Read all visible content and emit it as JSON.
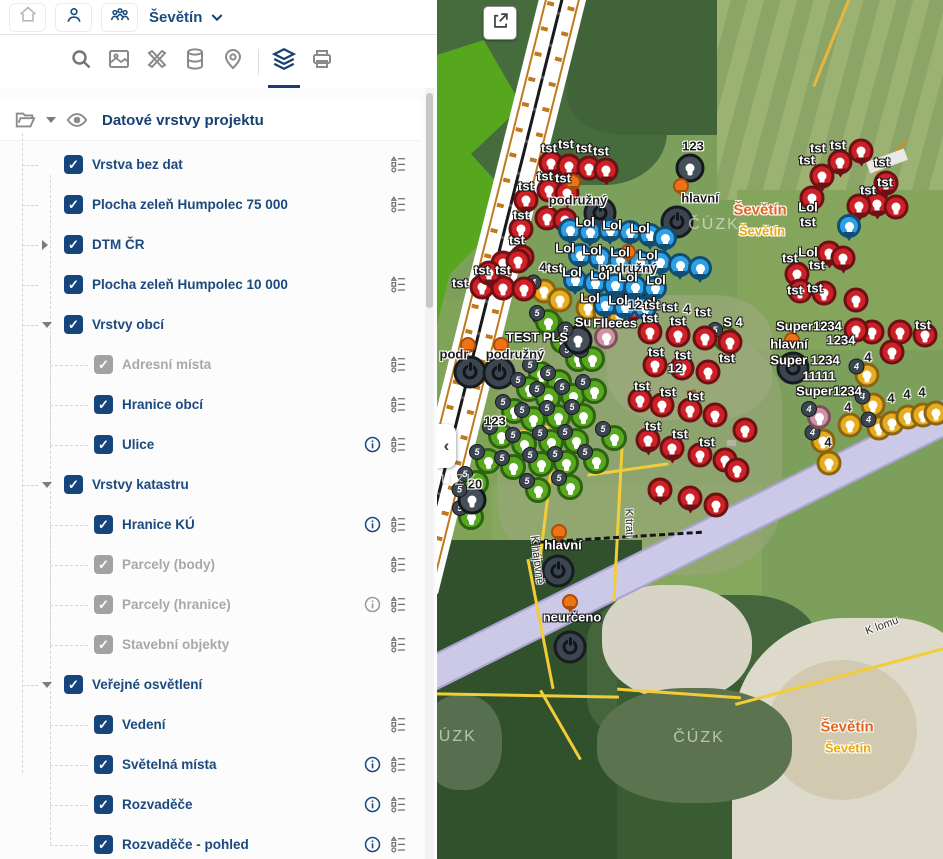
{
  "header": {
    "title": "Ševětín",
    "icons": [
      "home-icon",
      "user-icon",
      "team-icon",
      "chevron-down-icon"
    ]
  },
  "toolbar": {
    "icons": [
      "search-icon",
      "basemap-icon",
      "draw-tools-icon",
      "database-icon",
      "location-pin-icon",
      "layers-icon",
      "print-icon"
    ],
    "active_icon": "layers-icon"
  },
  "sidebar": {
    "panel_title": "Datové vrstvy projektu",
    "panel_icons": [
      "folder-open-icon",
      "chevron-down-icon",
      "eye-icon"
    ],
    "tree": [
      {
        "label": "Vrstva bez dat",
        "level": 1,
        "checked": true,
        "legend": true
      },
      {
        "label": "Plocha zeleň Humpolec 75 000",
        "level": 1,
        "checked": true,
        "legend": true
      },
      {
        "label": "DTM ČR",
        "level": 1,
        "checked": true,
        "arrow": "right"
      },
      {
        "label": "Plocha zeleň Humpolec 10 000",
        "level": 1,
        "checked": true,
        "legend": true
      },
      {
        "label": "Vrstvy obcí",
        "level": 1,
        "checked": true,
        "arrow": "down"
      },
      {
        "label": "Adresní místa",
        "level": 2,
        "checked": true,
        "disabled": true,
        "legend": true
      },
      {
        "label": "Hranice obcí",
        "level": 2,
        "checked": true,
        "legend": true
      },
      {
        "label": "Ulice",
        "level": 2,
        "checked": true,
        "info": true,
        "legend": true
      },
      {
        "label": "Vrstvy katastru",
        "level": 1,
        "checked": true,
        "arrow": "down"
      },
      {
        "label": "Hranice KÚ",
        "level": 2,
        "checked": true,
        "info": true,
        "legend": true
      },
      {
        "label": "Parcely (body)",
        "level": 2,
        "checked": true,
        "disabled": true,
        "legend": true
      },
      {
        "label": "Parcely (hranice)",
        "level": 2,
        "checked": true,
        "disabled": true,
        "info": true,
        "legend": true
      },
      {
        "label": "Stavební objekty",
        "level": 2,
        "checked": true,
        "disabled": true,
        "legend": true
      },
      {
        "label": "Veřejné osvětlení",
        "level": 1,
        "checked": true,
        "arrow": "down"
      },
      {
        "label": "Vedení",
        "level": 2,
        "checked": true,
        "legend": true
      },
      {
        "label": "Světelná místa",
        "level": 2,
        "checked": true,
        "info": true,
        "legend": true
      },
      {
        "label": "Rozvaděče",
        "level": 2,
        "checked": true,
        "info": true,
        "legend": true
      },
      {
        "label": "Rozvaděče - pohled",
        "level": 2,
        "checked": true,
        "info": true,
        "legend": true
      }
    ]
  },
  "map": {
    "collapse_glyph": "‹",
    "colors": {
      "red": "#cf2028",
      "green": "#58a81f",
      "blue": "#2da0e8",
      "yellow": "#e6ac1e",
      "pink": "#cf93a4",
      "dark": "#454f58",
      "orange": "#ee7317",
      "lavender": "#ccc8e8",
      "city_label": "#e0641e",
      "accent": "#15457c"
    },
    "markers": [
      [
        "dl",
        163,
        213
      ],
      [
        "dl",
        240,
        222
      ],
      [
        "dl",
        192,
        296
      ],
      [
        "dl",
        33,
        372
      ],
      [
        "dl",
        62,
        373
      ],
      [
        "dl",
        356,
        368
      ],
      [
        "dl",
        121,
        571
      ],
      [
        "dl",
        133,
        647
      ],
      [
        "gc",
        114,
        326,
        "5"
      ],
      [
        "gc",
        126,
        341,
        "5"
      ],
      [
        "gc",
        141,
        359,
        "5"
      ],
      [
        "gc",
        104,
        374,
        "5"
      ],
      [
        "gc",
        122,
        382,
        "5"
      ],
      [
        "gc",
        155,
        359,
        "5"
      ],
      [
        "gc",
        92,
        389,
        "5"
      ],
      [
        "gc",
        111,
        398,
        "5"
      ],
      [
        "gc",
        136,
        396,
        "5"
      ],
      [
        "gc",
        157,
        391,
        "5"
      ],
      [
        "gc",
        77,
        411,
        "5"
      ],
      [
        "gc",
        96,
        419,
        "5"
      ],
      [
        "gc",
        121,
        417,
        "5"
      ],
      [
        "gc",
        146,
        416,
        "5"
      ],
      [
        "gc",
        64,
        436,
        "5"
      ],
      [
        "gc",
        87,
        444,
        "5"
      ],
      [
        "gc",
        114,
        442,
        "5"
      ],
      [
        "gc",
        139,
        441,
        "5"
      ],
      [
        "gc",
        51,
        461,
        "5"
      ],
      [
        "gc",
        76,
        467,
        "5"
      ],
      [
        "gc",
        104,
        464,
        "5"
      ],
      [
        "gc",
        129,
        463,
        "5"
      ],
      [
        "gc",
        39,
        483,
        "5"
      ],
      [
        "gc",
        159,
        461,
        "5"
      ],
      [
        "gc",
        101,
        490,
        "5"
      ],
      [
        "gc",
        133,
        487,
        "5"
      ],
      [
        "gc",
        34,
        517,
        "5"
      ],
      [
        "gc",
        177,
        438,
        "5"
      ],
      [
        "gc",
        289,
        339,
        "5"
      ],
      [
        "gc",
        111,
        322,
        "5"
      ],
      [
        "yc",
        107,
        291,
        "4"
      ],
      [
        "yc",
        123,
        300
      ],
      [
        "yc",
        151,
        308
      ],
      [
        "yc",
        168,
        312
      ],
      [
        "yc",
        183,
        316
      ],
      [
        "yc",
        430,
        375,
        "4"
      ],
      [
        "yc",
        436,
        405,
        "4"
      ],
      [
        "yc",
        413,
        425
      ],
      [
        "yc",
        442,
        428,
        "4"
      ],
      [
        "yc",
        455,
        423
      ],
      [
        "yc",
        471,
        417
      ],
      [
        "yc",
        486,
        415
      ],
      [
        "yc",
        499,
        413
      ],
      [
        "yc",
        386,
        441,
        "4"
      ],
      [
        "yc",
        392,
        463
      ],
      [
        "pc",
        169,
        337
      ],
      [
        "pc",
        382,
        417,
        "4"
      ],
      [
        "rp",
        114,
        163
      ],
      [
        "rp",
        132,
        166
      ],
      [
        "rc",
        152,
        168
      ],
      [
        "rp",
        169,
        170
      ],
      [
        "rc",
        112,
        190
      ],
      [
        "rp",
        130,
        193
      ],
      [
        "rc",
        110,
        218
      ],
      [
        "rp",
        128,
        220
      ],
      [
        "rp",
        89,
        200
      ],
      [
        "rc",
        84,
        229
      ],
      [
        "rp",
        85,
        257
      ],
      [
        "rc",
        66,
        263
      ],
      [
        "rc",
        81,
        261
      ],
      [
        "rc",
        45,
        287
      ],
      [
        "rc",
        66,
        288
      ],
      [
        "rc",
        87,
        289
      ],
      [
        "rp",
        52,
        273
      ],
      [
        "rc",
        178,
        302
      ],
      [
        "rc",
        196,
        308
      ],
      [
        "rc",
        213,
        332
      ],
      [
        "rc",
        241,
        335
      ],
      [
        "rc",
        268,
        338
      ],
      [
        "rc",
        293,
        342
      ],
      [
        "rc",
        218,
        365
      ],
      [
        "rc",
        245,
        368
      ],
      [
        "rc",
        271,
        372
      ],
      [
        "rc",
        203,
        400
      ],
      [
        "rc",
        225,
        405
      ],
      [
        "rc",
        253,
        410
      ],
      [
        "rc",
        278,
        415
      ],
      [
        "rp",
        211,
        440
      ],
      [
        "rp",
        235,
        448
      ],
      [
        "rc",
        263,
        455
      ],
      [
        "rc",
        288,
        460
      ],
      [
        "rp",
        223,
        490
      ],
      [
        "rp",
        253,
        498
      ],
      [
        "rc",
        279,
        505
      ],
      [
        "rc",
        300,
        470
      ],
      [
        "rc",
        308,
        430
      ],
      [
        "rp",
        403,
        162
      ],
      [
        "rp",
        385,
        176
      ],
      [
        "rp",
        375,
        198
      ],
      [
        "rp",
        424,
        151
      ],
      [
        "rp",
        449,
        183
      ],
      [
        "rp",
        440,
        204
      ],
      [
        "rp",
        422,
        206
      ],
      [
        "rc",
        459,
        207
      ],
      [
        "rp",
        392,
        253
      ],
      [
        "rp",
        406,
        258
      ],
      [
        "rp",
        360,
        274
      ],
      [
        "rc",
        363,
        291
      ],
      [
        "rc",
        387,
        293
      ],
      [
        "rc",
        419,
        300
      ],
      [
        "rc",
        435,
        332
      ],
      [
        "rc",
        463,
        332
      ],
      [
        "rc",
        488,
        335
      ],
      [
        "rc",
        455,
        352
      ],
      [
        "rc",
        419,
        330
      ],
      [
        "bp",
        133,
        230
      ],
      [
        "bp",
        153,
        232
      ],
      [
        "bp",
        173,
        230
      ],
      [
        "bp",
        193,
        232
      ],
      [
        "bp",
        213,
        235
      ],
      [
        "bp",
        228,
        238
      ],
      [
        "bp",
        143,
        255
      ],
      [
        "bp",
        163,
        258
      ],
      [
        "bp",
        183,
        260
      ],
      [
        "bp",
        203,
        262
      ],
      [
        "bp",
        223,
        262
      ],
      [
        "bp",
        138,
        280
      ],
      [
        "bp",
        158,
        283
      ],
      [
        "bp",
        178,
        285
      ],
      [
        "bp",
        198,
        287
      ],
      [
        "bp",
        218,
        288
      ],
      [
        "bp",
        168,
        305
      ],
      [
        "bp",
        188,
        307
      ],
      [
        "bp",
        208,
        308
      ],
      [
        "bp",
        243,
        265
      ],
      [
        "bp",
        263,
        268
      ],
      [
        "bp",
        412,
        226
      ],
      [
        "dkc",
        253,
        168
      ],
      [
        "dkc",
        141,
        340,
        "5"
      ],
      [
        "dkc",
        35,
        500,
        "5"
      ],
      [
        "op",
        136,
        182
      ],
      [
        "op",
        244,
        186
      ],
      [
        "op",
        191,
        252
      ],
      [
        "op",
        31,
        345
      ],
      [
        "op",
        64,
        345
      ],
      [
        "op",
        122,
        532
      ],
      [
        "op",
        133,
        602
      ],
      [
        "op",
        355,
        340
      ]
    ],
    "labels": [
      [
        "tst",
        112,
        148,
        "l"
      ],
      [
        "tst",
        129,
        144,
        "l"
      ],
      [
        "tst",
        147,
        148,
        "l"
      ],
      [
        "tst",
        164,
        151,
        "l"
      ],
      [
        "tst",
        108,
        176,
        "l"
      ],
      [
        "tst",
        126,
        178,
        "l"
      ],
      [
        "tst",
        89,
        186,
        "l"
      ],
      [
        "tst",
        84,
        215,
        "l"
      ],
      [
        "tst",
        80,
        240,
        "l"
      ],
      [
        "tst",
        45,
        270,
        "l"
      ],
      [
        "tst",
        66,
        270,
        "l"
      ],
      [
        "tst",
        23,
        283,
        "l"
      ],
      [
        "tst",
        118,
        268,
        "l"
      ],
      [
        "4",
        106,
        267,
        "d"
      ],
      [
        "podružný",
        141,
        200,
        "d"
      ],
      [
        "hlavní",
        263,
        198,
        "d"
      ],
      [
        "podružný",
        191,
        268,
        "d"
      ],
      [
        "podr",
        17,
        354,
        "d"
      ],
      [
        "podružný",
        78,
        354,
        "d"
      ],
      [
        "123",
        256,
        146,
        "d"
      ],
      [
        "Lol",
        148,
        222,
        "l"
      ],
      [
        "Lol",
        175,
        225,
        "l"
      ],
      [
        "Lol",
        203,
        228,
        "l"
      ],
      [
        "Lol",
        128,
        248,
        "l"
      ],
      [
        "Lol",
        155,
        250,
        "l"
      ],
      [
        "Lol",
        183,
        252,
        "l"
      ],
      [
        "Lol",
        211,
        255,
        "l"
      ],
      [
        "Lol",
        135,
        272,
        "l"
      ],
      [
        "Lol",
        163,
        275,
        "l"
      ],
      [
        "Lol",
        191,
        277,
        "l"
      ],
      [
        "Lol",
        219,
        280,
        "l"
      ],
      [
        "Lol",
        153,
        298,
        "l"
      ],
      [
        "Lol",
        181,
        300,
        "l"
      ],
      [
        "Lol",
        209,
        302,
        "l"
      ],
      [
        "TEST PLS",
        100,
        337,
        "l"
      ],
      [
        "Su",
        146,
        322,
        "l"
      ],
      [
        "FIleees",
        178,
        323,
        "l"
      ],
      [
        "12",
        198,
        305,
        "d"
      ],
      [
        "tst",
        215,
        305,
        "l"
      ],
      [
        "tst",
        233,
        307,
        "l"
      ],
      [
        "4",
        250,
        309,
        "d"
      ],
      [
        "tst",
        266,
        312,
        "l"
      ],
      [
        "tst",
        213,
        318,
        "l"
      ],
      [
        "tst",
        241,
        321,
        "l"
      ],
      [
        "tst",
        219,
        352,
        "l"
      ],
      [
        "tst",
        246,
        355,
        "l"
      ],
      [
        "tst",
        290,
        358,
        "l"
      ],
      [
        "tst",
        205,
        386,
        "l"
      ],
      [
        "tst",
        231,
        392,
        "l"
      ],
      [
        "tst",
        259,
        396,
        "l"
      ],
      [
        "tst",
        216,
        426,
        "l"
      ],
      [
        "tst",
        243,
        434,
        "l"
      ],
      [
        "tst",
        270,
        442,
        "l"
      ],
      [
        "12",
        238,
        368,
        "l"
      ],
      [
        "tst",
        381,
        148,
        "l"
      ],
      [
        "tst",
        401,
        145,
        "l"
      ],
      [
        "tst",
        445,
        162,
        "l"
      ],
      [
        "tst",
        448,
        182,
        "l"
      ],
      [
        "tst",
        431,
        190,
        "l"
      ],
      [
        "tst",
        370,
        160,
        "l"
      ],
      [
        "tst",
        371,
        222,
        "l"
      ],
      [
        "tst",
        353,
        258,
        "l"
      ],
      [
        "tst",
        380,
        265,
        "l"
      ],
      [
        "tst",
        358,
        290,
        "l"
      ],
      [
        "tst",
        378,
        288,
        "l"
      ],
      [
        "tst",
        486,
        325,
        "l"
      ],
      [
        "Lol",
        371,
        207,
        "l"
      ],
      [
        "Lol",
        371,
        252,
        "l"
      ],
      [
        "S 4",
        296,
        322,
        "l"
      ],
      [
        "Super1234",
        372,
        326,
        "l"
      ],
      [
        "1234",
        404,
        340,
        "l"
      ],
      [
        "hlavní",
        352,
        344,
        "l"
      ],
      [
        "Super 1234",
        368,
        360,
        "l"
      ],
      [
        "11111",
        382,
        376,
        "l"
      ],
      [
        "Super1234",
        392,
        391,
        "l"
      ],
      [
        "4",
        431,
        357,
        "d"
      ],
      [
        "4",
        454,
        398,
        "d"
      ],
      [
        "4",
        470,
        394,
        "d"
      ],
      [
        "4",
        485,
        392,
        "d"
      ],
      [
        "4",
        411,
        407,
        "d"
      ],
      [
        "4",
        391,
        442,
        "d"
      ],
      [
        "123",
        58,
        421,
        "d"
      ],
      [
        "20",
        38,
        484,
        "d"
      ],
      [
        "hlavní",
        126,
        545,
        "l"
      ],
      [
        "neurčeno",
        135,
        617,
        "l"
      ],
      [
        "Ševětín",
        323,
        210,
        "c1"
      ],
      [
        "Ševětín",
        325,
        231,
        "c2"
      ],
      [
        "Ševětín",
        410,
        727,
        "c1"
      ],
      [
        "Ševětín",
        411,
        748,
        "c2"
      ],
      [
        "K hájovně",
        100,
        560,
        "st",
        83
      ],
      [
        "K trati",
        192,
        523,
        "st",
        88
      ],
      [
        "K lomu",
        445,
        626,
        "st",
        -20
      ],
      [
        "ČÚZK",
        16,
        481,
        "wm"
      ],
      [
        "ČÚZK",
        14,
        737,
        "wm"
      ],
      [
        "ČÚZK",
        262,
        738,
        "wm"
      ],
      [
        "ČÚZK",
        277,
        225,
        "wm"
      ]
    ]
  }
}
